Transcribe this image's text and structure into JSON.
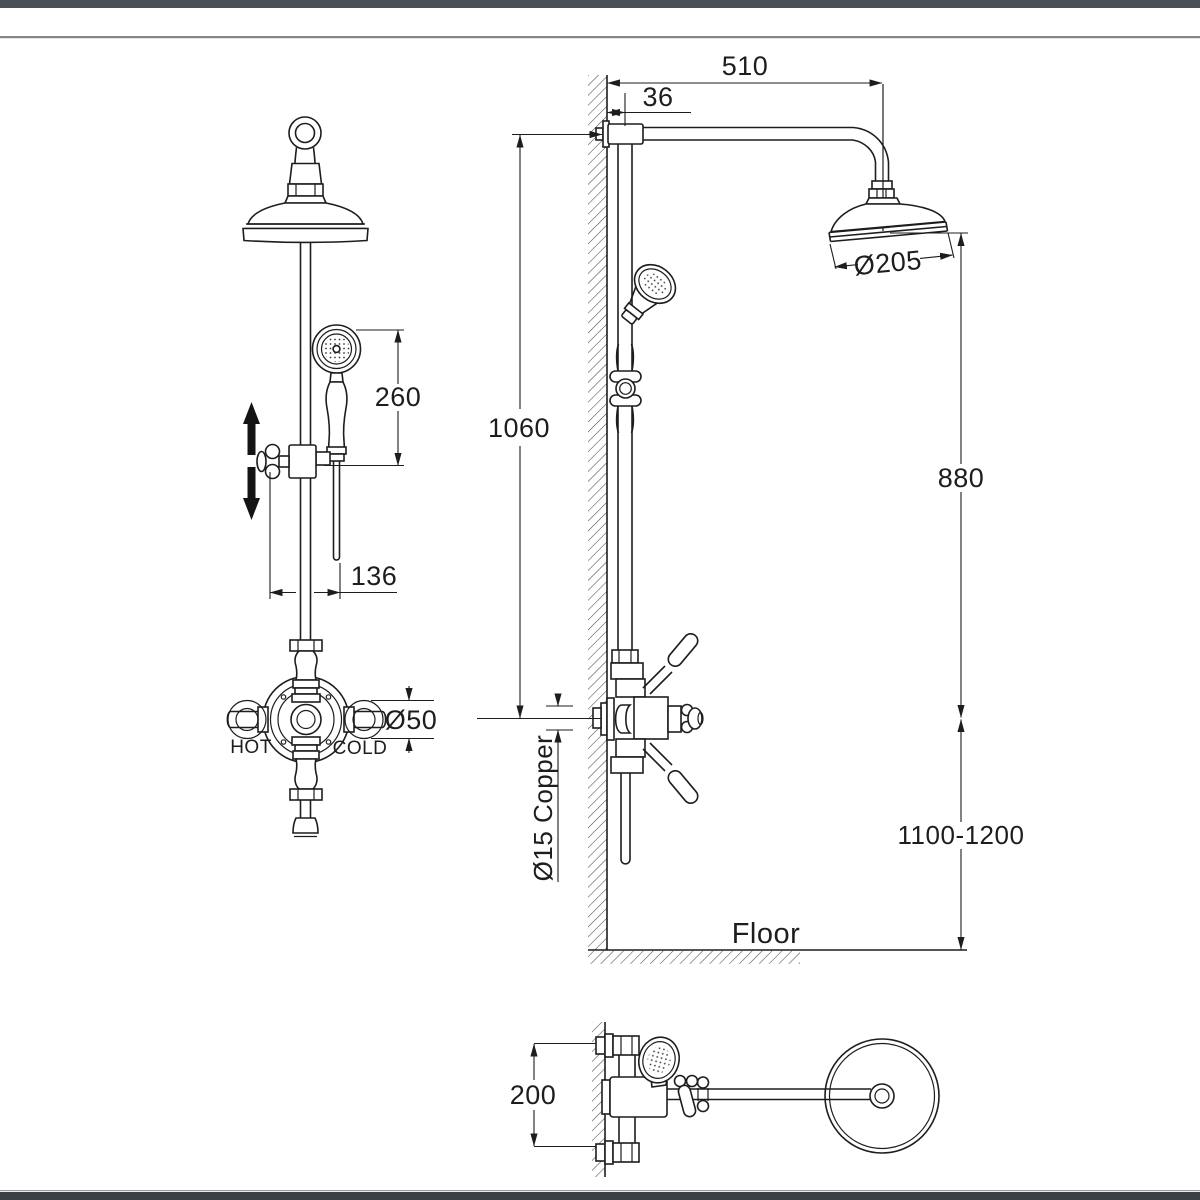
{
  "page": {
    "background": "#ffffff",
    "top_bar_color": "#465059",
    "bottom_bar_color": "#3b4046",
    "divider_color": "#858585",
    "line_color": "#1d1d1d"
  },
  "front_view": {
    "dim_260": "260",
    "dim_136": "136",
    "dim_diameter_50": "Ø50",
    "label_hot": "HOT",
    "label_cold": "COLD"
  },
  "side_view": {
    "dim_510": "510",
    "dim_36": "36",
    "dim_diameter_205": "Ø205",
    "dim_1060": "1060",
    "dim_880": "880",
    "dim_height_range": "1100-1200",
    "label_pipe": "Ø15 Copper",
    "label_floor": "Floor"
  },
  "plan_view": {
    "dim_200": "200"
  }
}
